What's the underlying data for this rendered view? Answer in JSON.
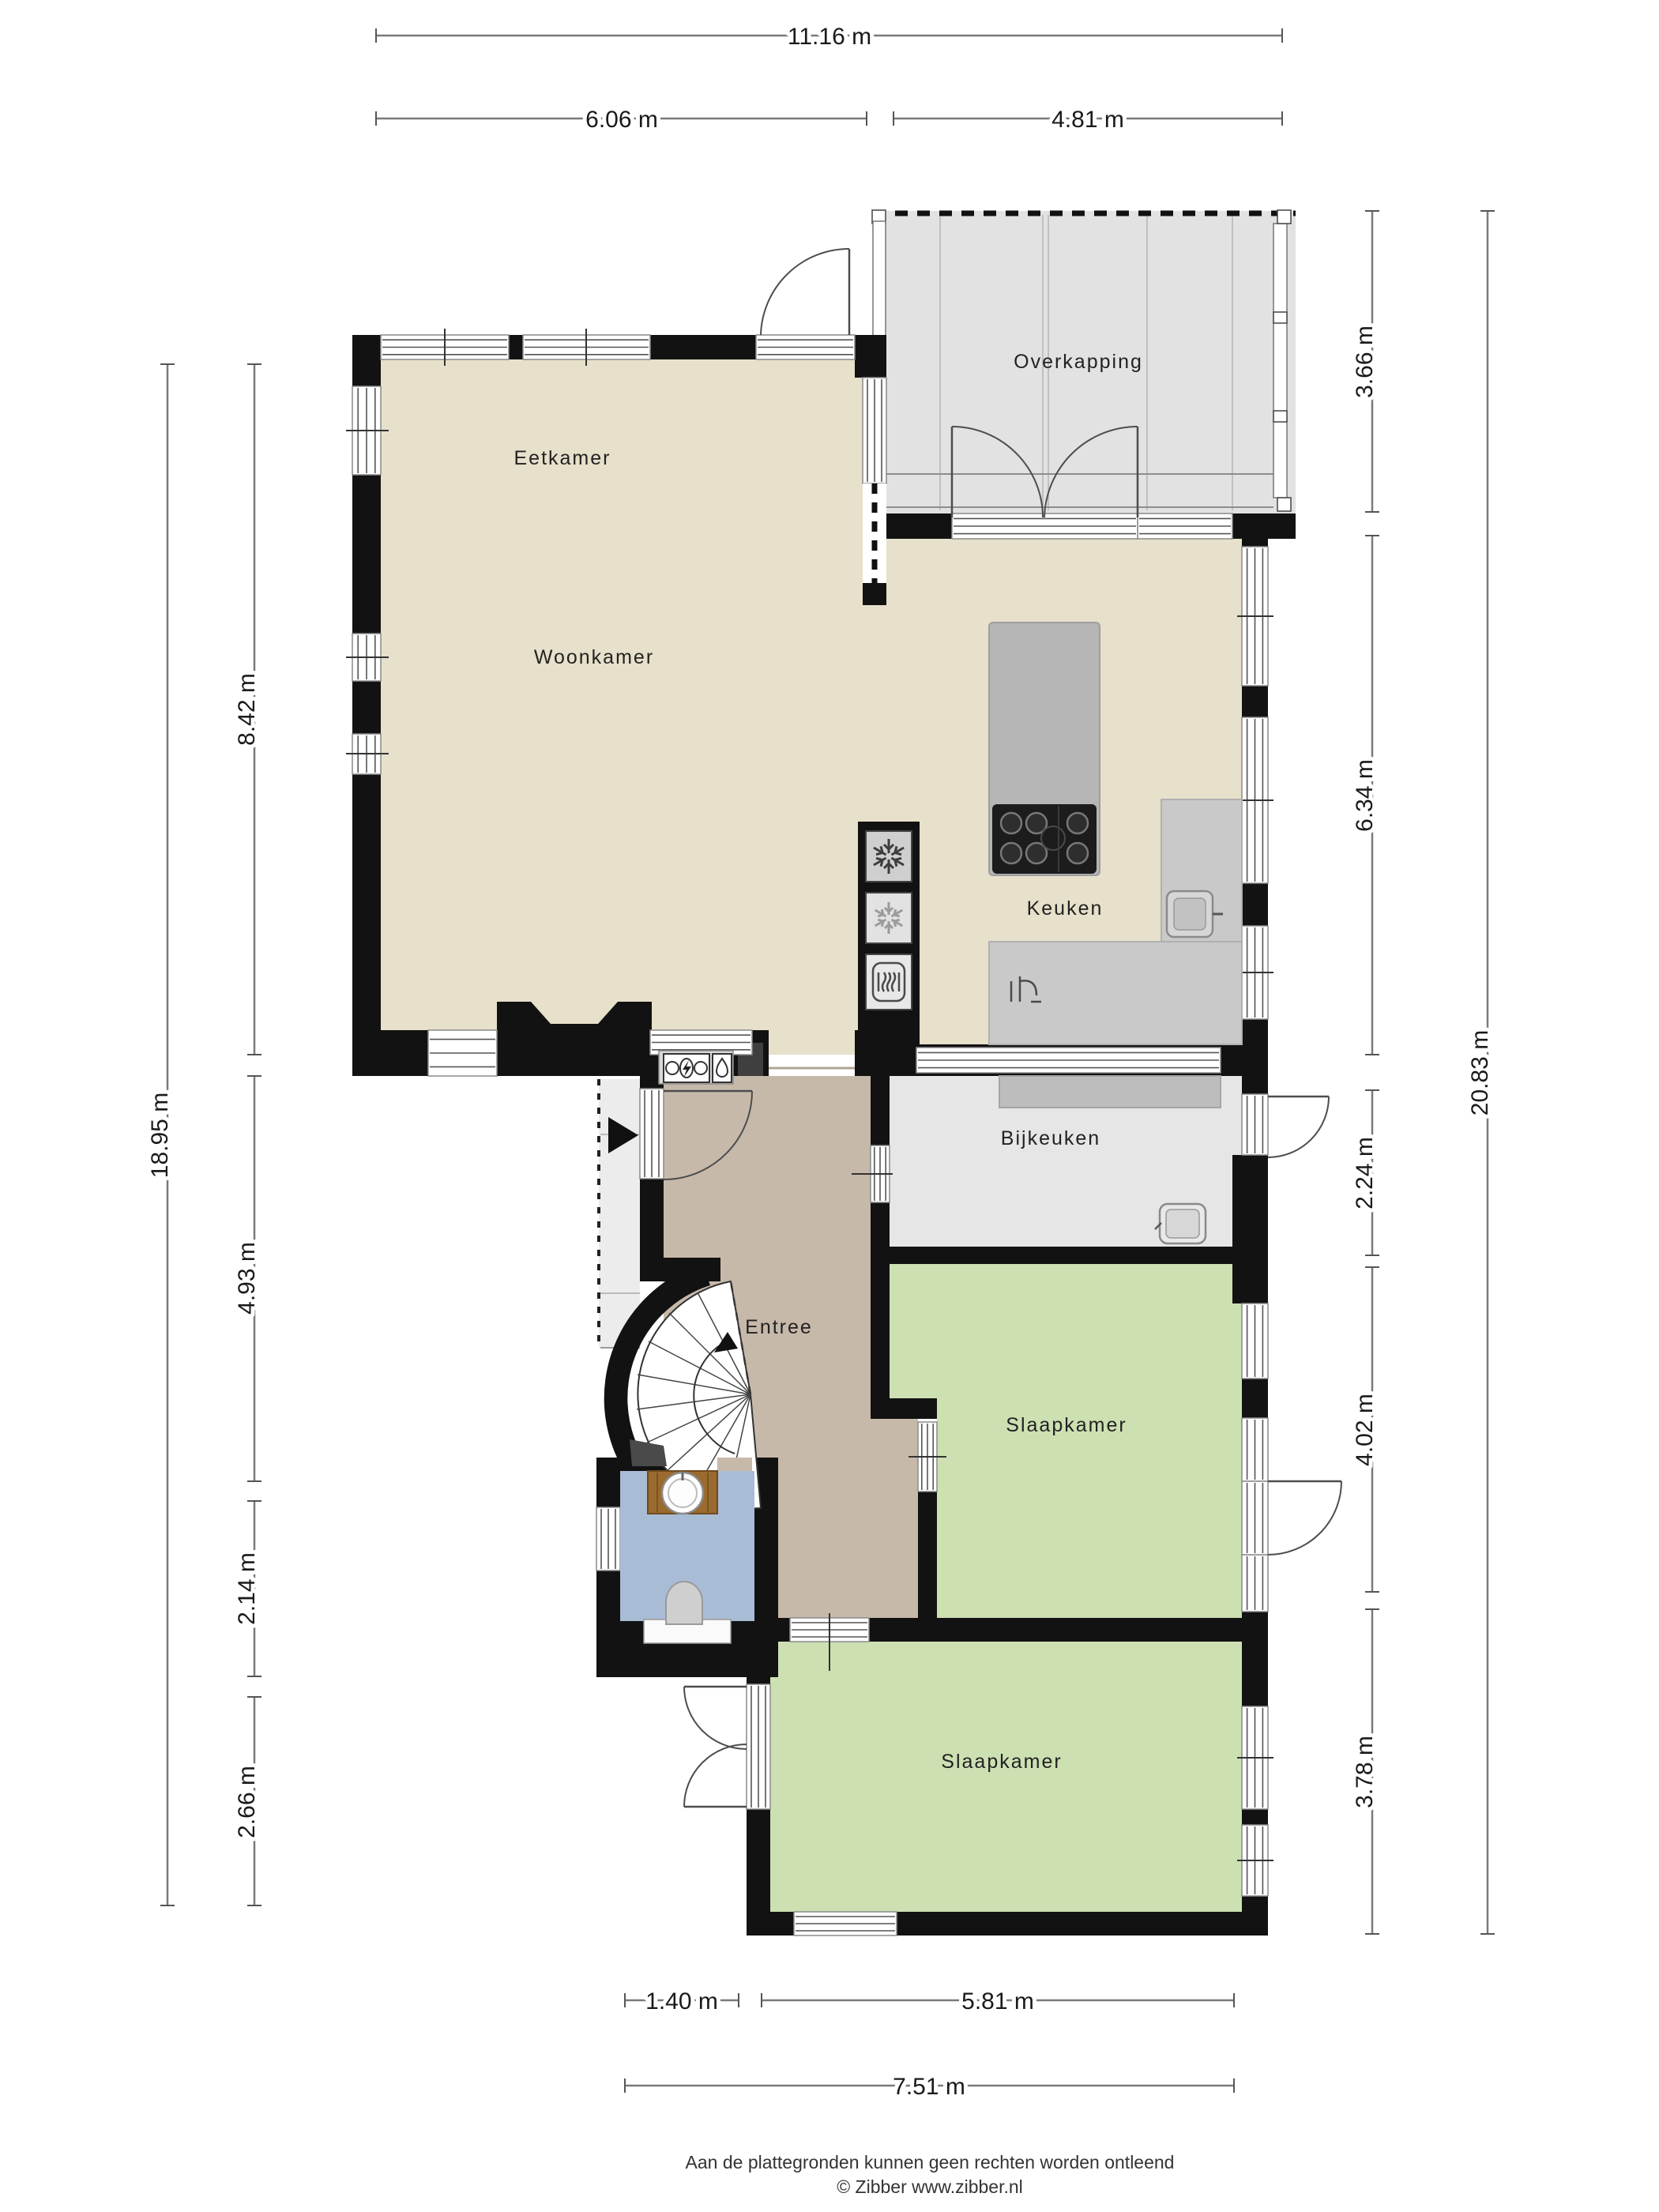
{
  "plan": {
    "rooms": {
      "overkapping": {
        "label": "Overkapping"
      },
      "eetkamer": {
        "label": "Eetkamer"
      },
      "woonkamer": {
        "label": "Woonkamer"
      },
      "keuken": {
        "label": "Keuken"
      },
      "bijkeuken": {
        "label": "Bijkeuken"
      },
      "entree": {
        "label": "Entree"
      },
      "slaapkamer1": {
        "label": "Slaapkamer"
      },
      "slaapkamer2": {
        "label": "Slaapkamer"
      }
    },
    "dimensions": {
      "top_total": "11.16 m",
      "top_left": "6.06 m",
      "top_right": "4.81 m",
      "left_total": "18.95 m",
      "left_segments": [
        "8.42 m",
        "4.93 m",
        "2.14 m",
        "2.66 m"
      ],
      "right_total": "20.83 m",
      "right_segments": [
        "3.66 m",
        "6.34 m",
        "2.24 m",
        "4.02 m",
        "3.78 m"
      ],
      "bottom_segments": [
        "1.40 m",
        "5.81 m"
      ],
      "bottom_total": "7.51 m"
    },
    "footer": {
      "disclaimer": "Aan de plattegronden kunnen geen rechten worden ontleend",
      "copyright": "© Zibber www.zibber.nl"
    },
    "colors": {
      "wall": "#121212",
      "floor_living": "#e7e0ca",
      "floor_entree": "#c7b9aa",
      "floor_bedroom": "#cde0b2",
      "floor_toilet": "#a9bcd6",
      "floor_utility": "#e6e6e6",
      "terrace": "#e2e2e2",
      "counter": "#c9c9c9",
      "counter_dark": "#bdbdbd",
      "island": "#b6b6b6",
      "cooktop": "#1c1c1c",
      "wood": "#9b6a2f",
      "stair": "#ffffff"
    },
    "icons": [
      "freezer-snowflake-icon",
      "fridge-snowflake-icon",
      "oven-icon",
      "cooktop-burners-icon",
      "kitchen-sink-icon",
      "utility-sink-icon",
      "faucet-icon",
      "toilet-icon",
      "washbasin-icon",
      "spiral-staircase-icon",
      "entrance-arrow-icon",
      "stair-direction-arrow-icon",
      "electricity-meter-icon",
      "water-meter-icon",
      "gas-meter-icon"
    ]
  }
}
